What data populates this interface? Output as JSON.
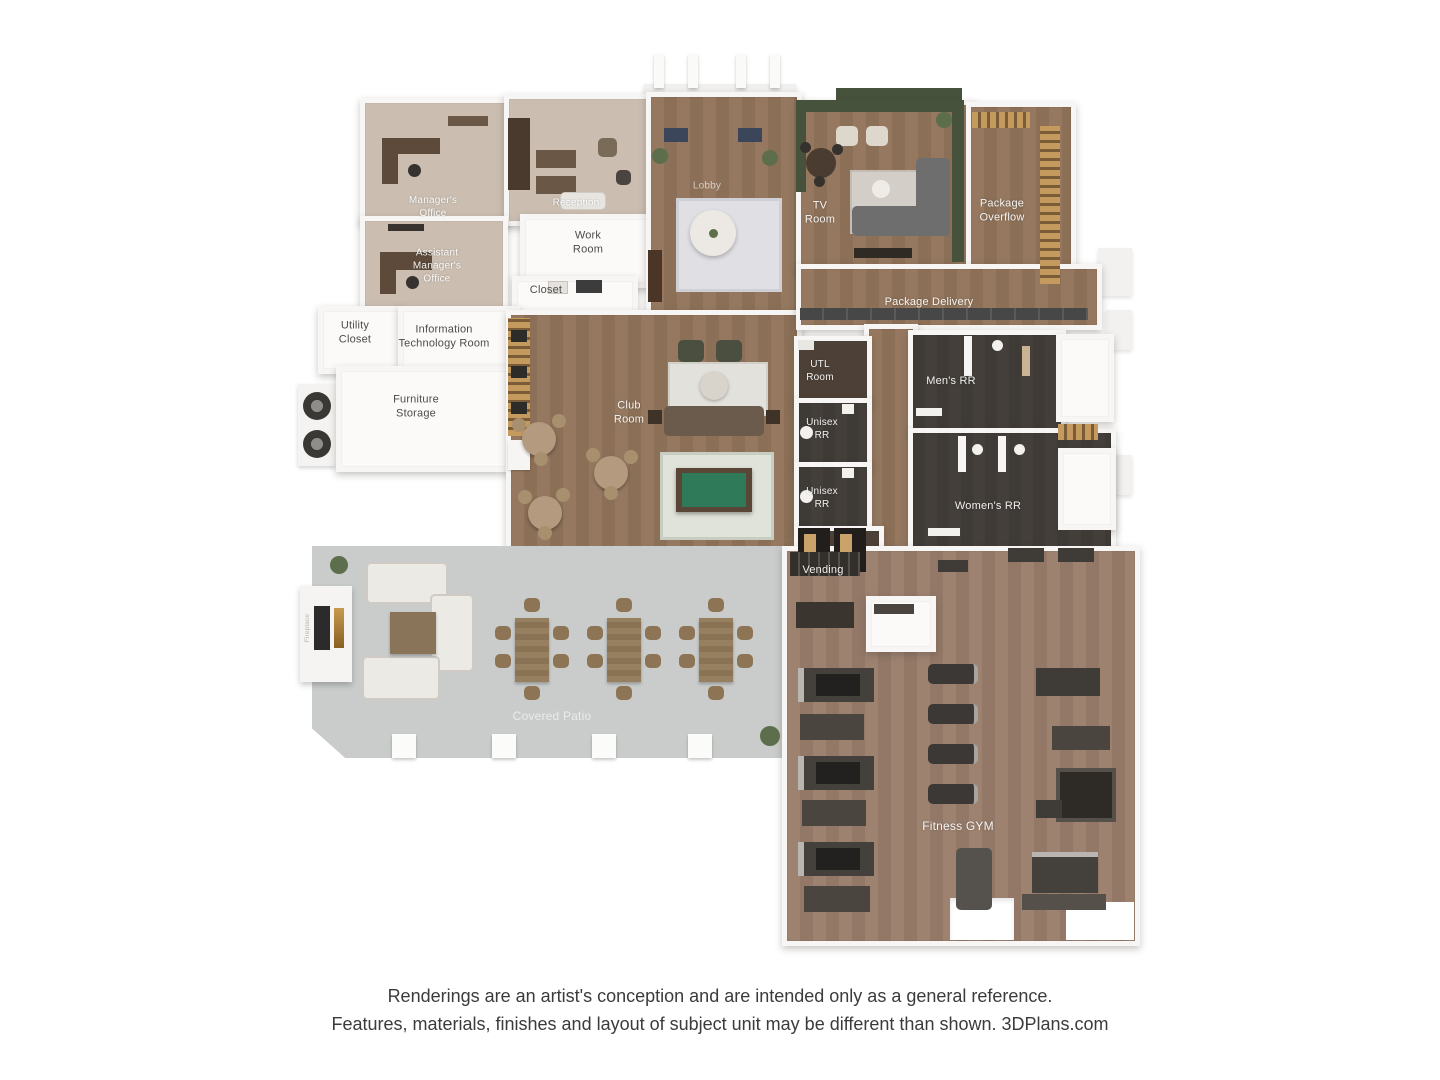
{
  "rooms": {
    "managers_office": "Manager's Office",
    "reception": "Reception",
    "assistant_managers_office": "Assistant Manager's Office",
    "work_room": "Work Room",
    "closet": "Closet",
    "utility_closet": "Utility Closet",
    "it_room": "Information Technology  Room",
    "furniture_storage": "Furniture Storage",
    "lobby": "Lobby",
    "club_room": "Club Room",
    "tv_room": "TV Room",
    "package_overflow": "Package Overflow",
    "package_delivery": "Package Delivery",
    "utl_room": "UTL Room",
    "mens_rr": "Men's RR",
    "unisex_rr_1": "Unisex RR",
    "unisex_rr_2": "Unisex RR",
    "womens_rr": "Women's RR",
    "vending": "Vending",
    "covered_patio": "Covered Patio",
    "fitness_gym": "Fitness GYM",
    "fireplace": "Fireplace"
  },
  "disclaimer": {
    "line1": "Renderings are an artist's conception and are intended only as a general reference.",
    "line2": "Features, materials, finishes and layout of subject unit may be different than shown. 3DPlans.com"
  },
  "colors": {
    "wood_floor": "#95785f",
    "gym_wood_floor": "#9d8270",
    "office_carpet": "#cbbeb1",
    "restroom_tile": "#3e3a36",
    "patio_concrete": "#c9cccb",
    "wall_white": "#f7f6f4",
    "accent_wall_green": "#47523c",
    "pool_table_felt": "#2f7a58"
  }
}
